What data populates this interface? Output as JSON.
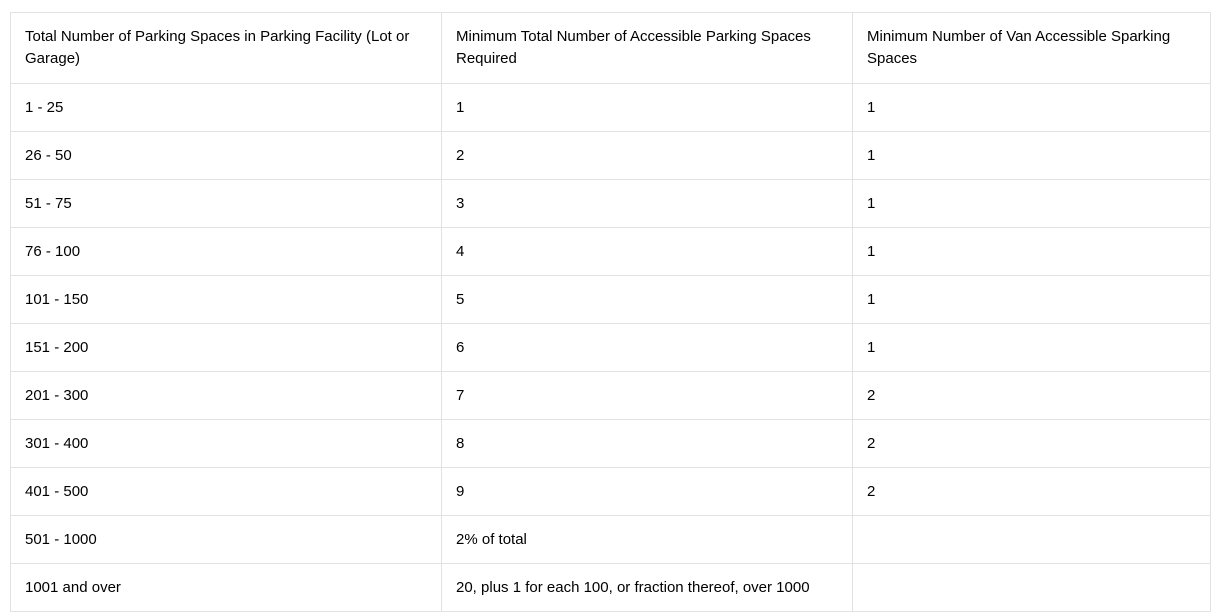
{
  "table": {
    "columns": [
      "Total Number of Parking Spaces in Parking Facility (Lot or Garage)",
      "Minimum Total Number of Accessible Parking Spaces Required",
      "Minimum Number of Van Accessible Sparking Spaces"
    ],
    "rows": [
      {
        "cells": [
          "1 - 25",
          "1",
          "1"
        ]
      },
      {
        "cells": [
          "26 - 50",
          "2",
          "1"
        ]
      },
      {
        "cells": [
          "51 - 75",
          "3",
          "1"
        ]
      },
      {
        "cells": [
          "76 - 100",
          "4",
          "1"
        ]
      },
      {
        "cells": [
          "101 - 150",
          "5",
          "1"
        ]
      },
      {
        "cells": [
          "151 - 200",
          "6",
          "1"
        ]
      },
      {
        "cells": [
          "201 - 300",
          "7",
          "2"
        ]
      },
      {
        "cells": [
          "301 - 400",
          "8",
          "2"
        ]
      },
      {
        "cells": [
          "401 - 500",
          "9",
          "2"
        ]
      },
      {
        "cells": [
          "501 - 1000",
          "2% of total",
          ""
        ]
      },
      {
        "cells": [
          "1001 and over",
          "20, plus 1 for each 100, or fraction thereof, over 1000",
          ""
        ]
      }
    ],
    "border_color": "#e2e2e2",
    "cell_background": "#ffffff",
    "text_color": "#000000"
  }
}
